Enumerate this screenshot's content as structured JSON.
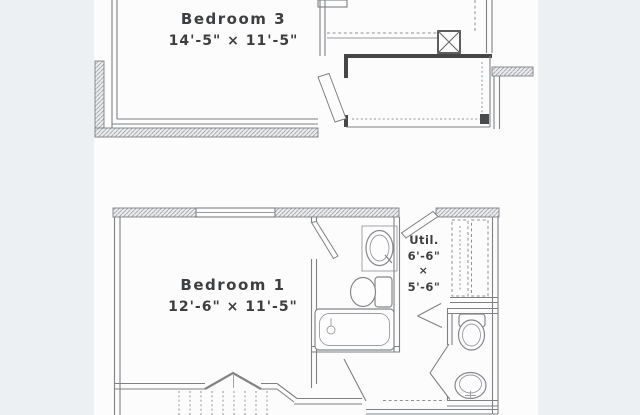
{
  "image": {
    "kind": "real-estate floor plan, two stacked partial floor levels",
    "colors": {
      "page_margin": "#edf0f3",
      "paper": "#fcfcfc",
      "wall_dark": "#454648",
      "line_gray": "#7e8084",
      "text": "#3d3e40"
    }
  },
  "upper_plan": {
    "room": {
      "name": "Bedroom 3",
      "dimensions": "14'-5\" × 11'-5\""
    }
  },
  "lower_plan": {
    "room": {
      "name": "Bedroom 1",
      "dimensions": "12'-6\" × 11'-5\""
    },
    "utility": {
      "name": "Util.",
      "width": "6'-6\"",
      "times": "×",
      "depth": "5'-6\""
    }
  }
}
